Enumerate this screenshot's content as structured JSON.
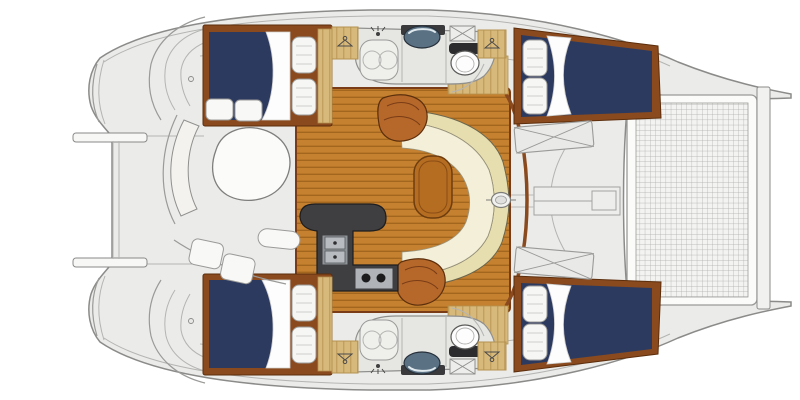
{
  "figure": {
    "type": "floor-plan",
    "subject": "catamaran sailing yacht interior layout",
    "view": "top-down",
    "orientation": "bow-right-stern-left",
    "berth_count": 4,
    "head_count": 2
  },
  "colors": {
    "background": "#ffffff",
    "deck": "#ebebe9",
    "deck_line": "#8b8b89",
    "navy_bedding": "#2d3a5f",
    "bed_frame": "#8a4a1e",
    "teak": "#c5812f",
    "teak_stripe": "#a2661e",
    "light_wood": "#d8b97c",
    "light_wood_grain": "#c2a05f",
    "cream_back": "#e7deb0",
    "cream_seat": "#f4efd8",
    "table_wood": "#b56d22",
    "step_wood": "#b5682a",
    "galley_dark": "#3f3f42",
    "metal": "#b0b4b8",
    "white_fixture": "#fbfbfa",
    "head_floor": "#e6e6e3",
    "net_bg": "#f3f3f1",
    "net_line": "#aaaaa8",
    "sink_glass": "#5a7083",
    "trim_brown": "#8a4a1e"
  },
  "components": [
    {
      "name": "aft-cabin-double-berth",
      "qty": 2
    },
    {
      "name": "forward-cabin-double-berth",
      "qty": 2
    },
    {
      "name": "bed-pillow",
      "qty": 8
    },
    {
      "name": "head-compartment",
      "qty": 2
    },
    {
      "name": "shower-stall",
      "qty": 2
    },
    {
      "name": "toilet",
      "qty": 2
    },
    {
      "name": "washbasin",
      "qty": 2
    },
    {
      "name": "hanging-locker-wardrobe",
      "qty": 4
    },
    {
      "name": "overhead-hatch",
      "qty": 2
    },
    {
      "name": "foredeck-hatch",
      "qty": 2
    },
    {
      "name": "saloon-settee",
      "qty": 1
    },
    {
      "name": "saloon-table",
      "qty": 1
    },
    {
      "name": "companionway-steps",
      "qty": 2
    },
    {
      "name": "galley-sink",
      "qty": 2
    },
    {
      "name": "stove-burner",
      "qty": 2
    },
    {
      "name": "cockpit-table",
      "qty": 1
    },
    {
      "name": "cockpit-bench",
      "qty": 3
    },
    {
      "name": "anchor-locker",
      "qty": 1
    },
    {
      "name": "mast-step",
      "qty": 1
    },
    {
      "name": "trampoline",
      "qty": 1
    },
    {
      "name": "bow-crossbeam",
      "qty": 1
    },
    {
      "name": "stern-swim-platform",
      "qty": 2
    },
    {
      "name": "boarding-rail",
      "qty": 2
    }
  ]
}
